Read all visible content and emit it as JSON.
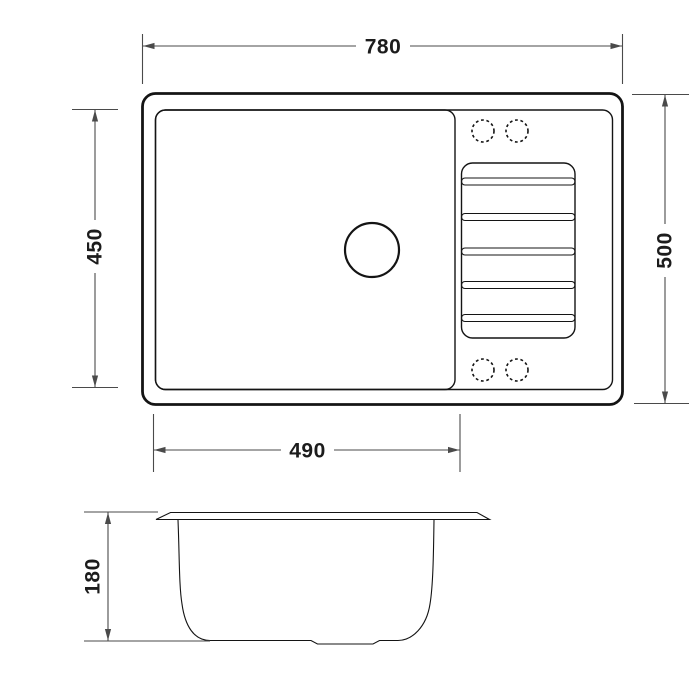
{
  "diagram": {
    "type": "technical-drawing",
    "subject": "kitchen sink with drainboard - top view and section view",
    "colors": {
      "background": "#ffffff",
      "outline": "#141414",
      "dimension": "#4a4a4a",
      "text": "#1c1c1c"
    },
    "top_view": {
      "dimensions": {
        "overall_width": "780",
        "overall_depth": "500",
        "bowl_front_to_back": "450",
        "bowl_width": "490"
      }
    },
    "section_view": {
      "dimensions": {
        "bowl_depth": "180"
      }
    }
  }
}
